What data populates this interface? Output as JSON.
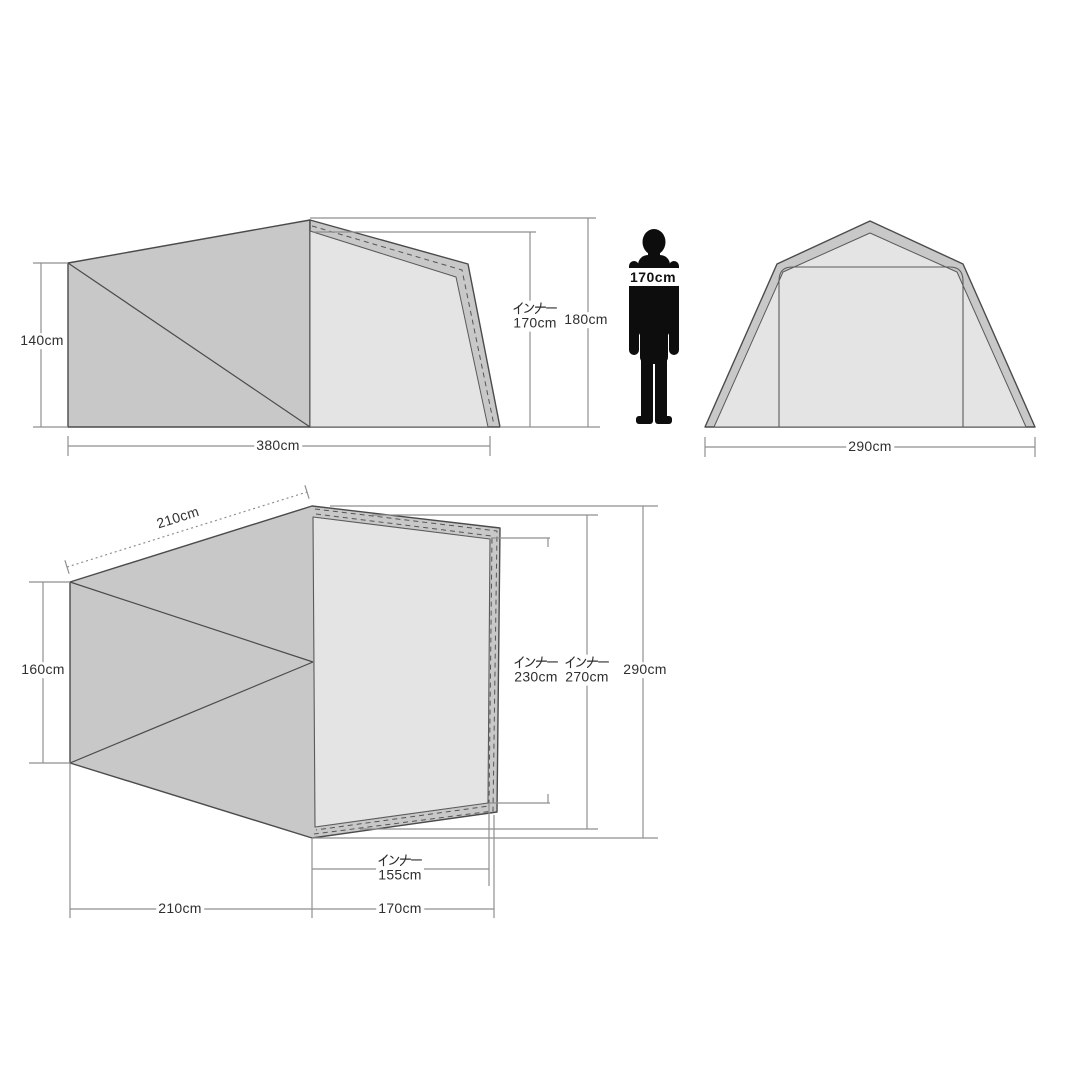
{
  "title": "tent-dimensions-diagram",
  "colors": {
    "fly_fabric": "#c8c8c8",
    "inner_panel": "#e4e4e4",
    "outline": "#4b4b4b",
    "dimension_line": "#8f8f8f",
    "text": "#2f2f2f",
    "silhouette": "#0d0d0d"
  },
  "side_view": {
    "height": "140cm",
    "length": "380cm",
    "inner_height_label": "インナー",
    "inner_height": "170cm",
    "total_height": "180cm"
  },
  "person": {
    "height": "170cm"
  },
  "front_view": {
    "width": "290cm"
  },
  "top_view": {
    "ridge_length": "210cm",
    "rear_width": "160cm",
    "inner_width_front_label": "インナー",
    "inner_width_front": "230cm",
    "inner_width_rear_label": "インナー",
    "inner_width_rear": "270cm",
    "total_width": "290cm",
    "inner_length_label": "インナー",
    "inner_length": "155cm",
    "vestibule_length": "210cm",
    "inner_section_length": "170cm"
  }
}
